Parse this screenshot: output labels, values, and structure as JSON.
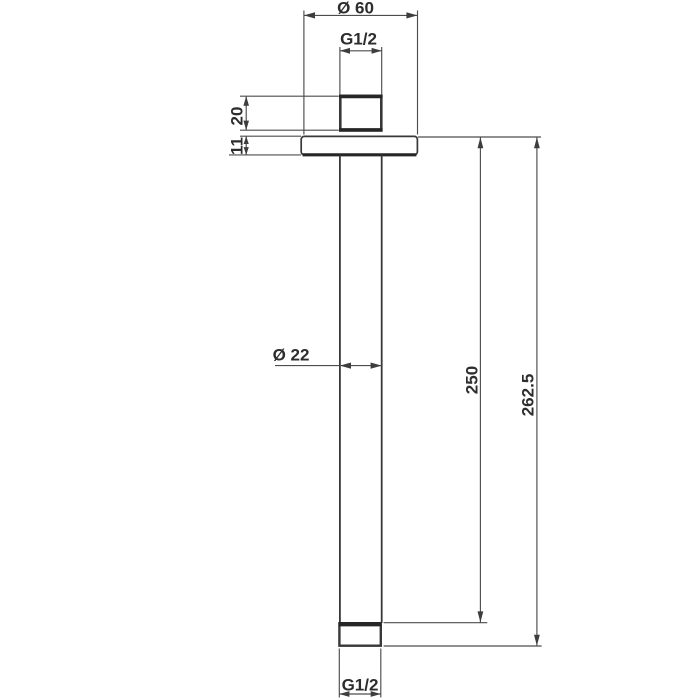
{
  "page": {
    "background_color": "#ffffff"
  },
  "drawing": {
    "kind": "technical-dimension-drawing",
    "line_color": "#3a3a3a",
    "text_color": "#2d2d2d",
    "labels": {
      "flange_diameter": "Ø 60",
      "top_thread": "G1/2",
      "connector_height": "20",
      "flange_thickness": "11",
      "pipe_diameter": "Ø 22",
      "length_to_pipe_end": "250",
      "overall_length": "262.5",
      "bottom_thread": "G1/2"
    }
  }
}
